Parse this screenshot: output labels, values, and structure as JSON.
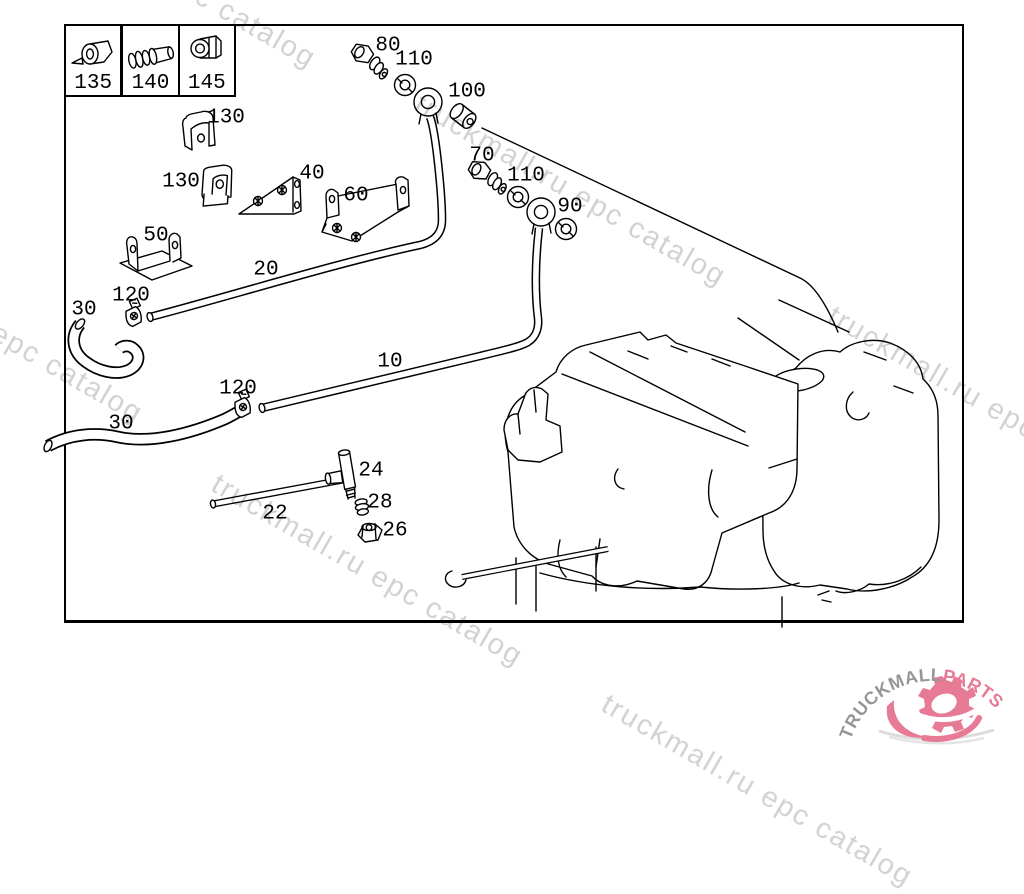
{
  "watermark": {
    "text": "truckmall.ru epc catalog",
    "color": "#d2d2d2",
    "angle_deg": 30,
    "instances": [
      {
        "x": 15,
        "y": -130
      },
      {
        "x": 425,
        "y": 88
      },
      {
        "x": 838,
        "y": 300
      },
      {
        "x": -158,
        "y": 225
      },
      {
        "x": 222,
        "y": 468
      },
      {
        "x": 612,
        "y": 688
      }
    ]
  },
  "legend": {
    "items": [
      {
        "label": "135"
      },
      {
        "label": "140"
      },
      {
        "label": "145"
      }
    ]
  },
  "callouts": [
    {
      "label": "80",
      "x": 388,
      "y": 46
    },
    {
      "label": "110",
      "x": 414,
      "y": 60
    },
    {
      "label": "100",
      "x": 467,
      "y": 92
    },
    {
      "label": "130",
      "x": 226,
      "y": 118
    },
    {
      "label": "130",
      "x": 181,
      "y": 182
    },
    {
      "label": "40",
      "x": 312,
      "y": 174
    },
    {
      "label": "70",
      "x": 482,
      "y": 156
    },
    {
      "label": "110",
      "x": 526,
      "y": 176
    },
    {
      "label": "90",
      "x": 570,
      "y": 207
    },
    {
      "label": "60",
      "x": 356,
      "y": 196
    },
    {
      "label": "50",
      "x": 156,
      "y": 236
    },
    {
      "label": "20",
      "x": 266,
      "y": 270
    },
    {
      "label": "120",
      "x": 131,
      "y": 296
    },
    {
      "label": "30",
      "x": 84,
      "y": 310
    },
    {
      "label": "10",
      "x": 390,
      "y": 362
    },
    {
      "label": "120",
      "x": 238,
      "y": 389
    },
    {
      "label": "30",
      "x": 121,
      "y": 424
    },
    {
      "label": "22",
      "x": 275,
      "y": 514
    },
    {
      "label": "24",
      "x": 371,
      "y": 471
    },
    {
      "label": "28",
      "x": 380,
      "y": 503
    },
    {
      "label": "26",
      "x": 395,
      "y": 531
    }
  ],
  "logo": {
    "name": "TRUCKMALL",
    "suffix": "PARTS",
    "name_color": "#969696",
    "suffix_color": "#e77a95"
  }
}
